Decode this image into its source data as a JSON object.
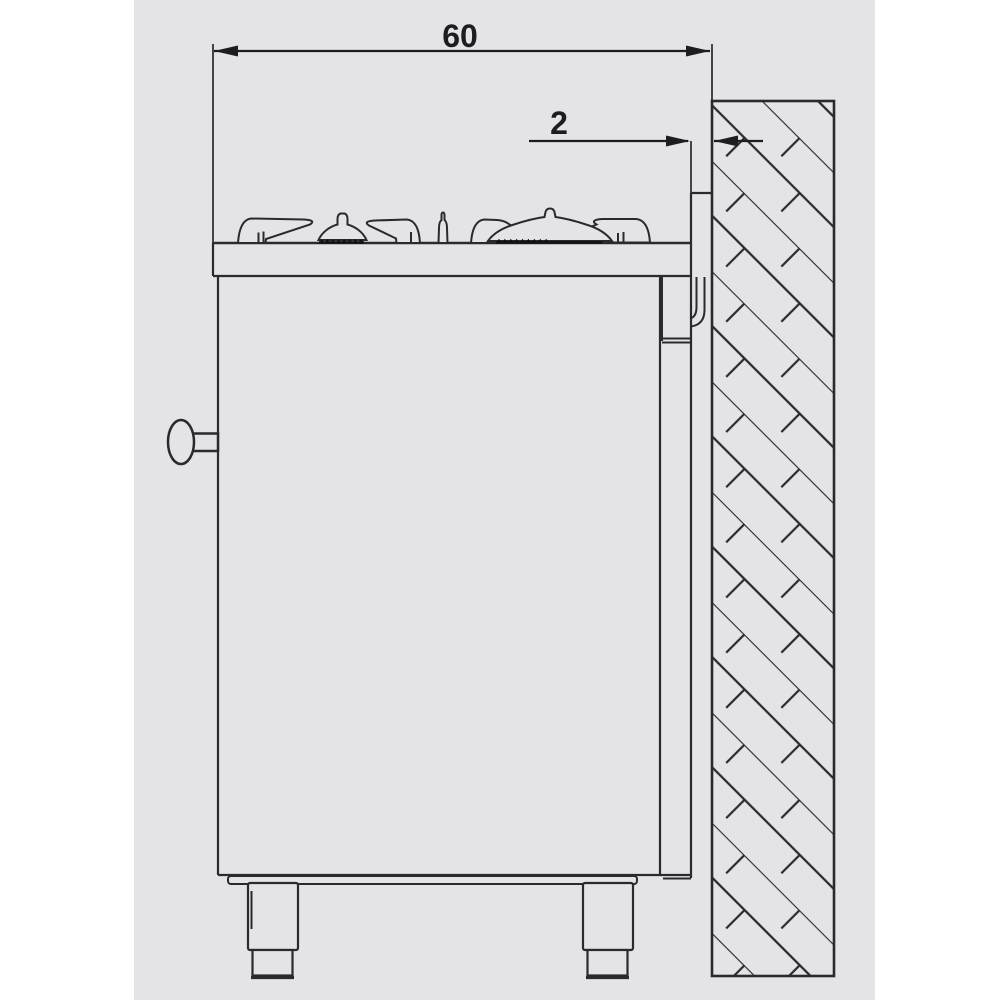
{
  "page": {
    "background": "#ffffff",
    "canvas_background": "#e4e4e6",
    "line_color": "#2a2a2e"
  },
  "diagram": {
    "type": "technical-installation-drawing",
    "subject": "gas-range-side-view-with-wall-clearance",
    "dimensions": {
      "total_depth": {
        "value": "60"
      },
      "wall_clearance": {
        "value": "2"
      }
    }
  }
}
